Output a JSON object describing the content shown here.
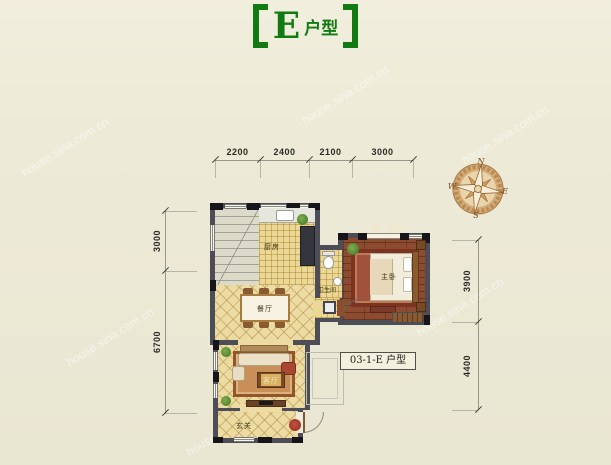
{
  "title": {
    "bracket_left": "【",
    "text_main": "E",
    "text_sub": "户型",
    "bracket_right": "】"
  },
  "floorplan": {
    "unit_label": "03-1-E 户型",
    "rooms": {
      "kitchen": "厨房",
      "bathroom": "卫生间",
      "dining": "餐厅",
      "living": "客厅",
      "master_bedroom": "主卧",
      "foyer": "玄关"
    }
  },
  "dimensions": {
    "top": [
      "2200",
      "2400",
      "2100",
      "3000"
    ],
    "left": [
      "3000",
      "6700"
    ],
    "right": [
      "3900",
      "4400"
    ]
  },
  "compass": {
    "north": "N",
    "south": "S",
    "east": "E",
    "west": "W"
  },
  "watermark": {
    "text": "house.sina.com.cn"
  },
  "colors": {
    "title_green": "#127a12",
    "background": "#edead7",
    "wall": "#4d4d57",
    "tile_floor": "#ecdca4",
    "wood_floor": "#8d4c30",
    "rug": "#a0523c"
  }
}
